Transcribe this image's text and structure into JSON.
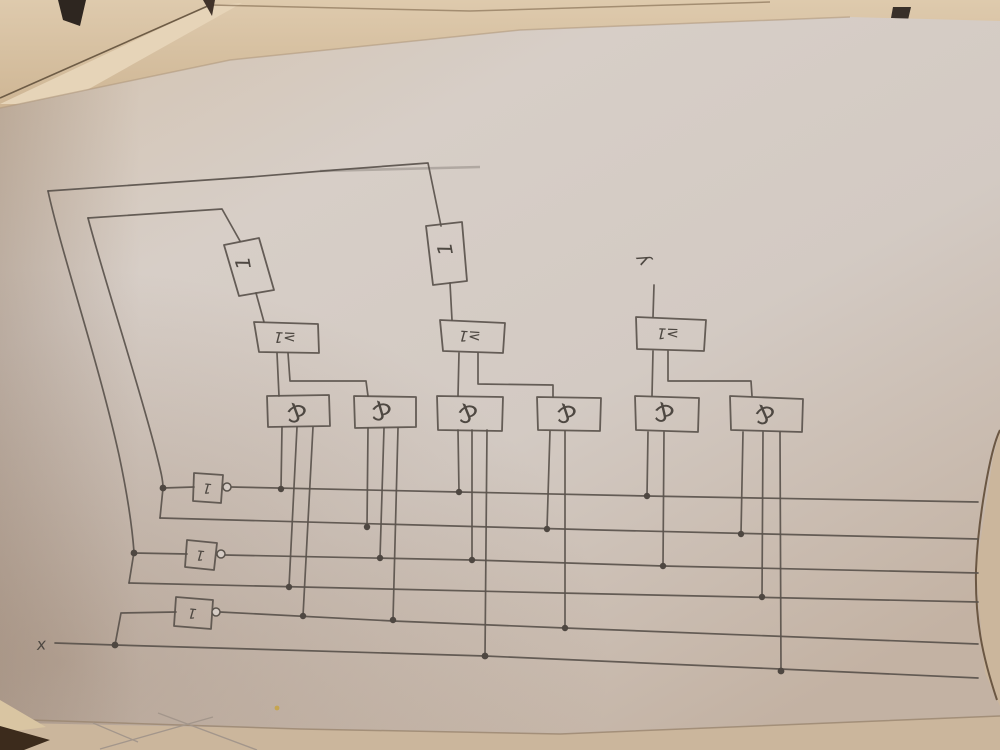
{
  "scene": {
    "description": "Photograph of a hand-drawn digital logic schematic (IEC rectangular symbols) in pencil on a sheet of paper lying on a brown surface with other papers",
    "paper_color": "#d6cdc6",
    "ink_color": "#5a534c",
    "surface_color": "#3c2b1c",
    "top_papers_color": "#e0cdb1"
  },
  "ports": {
    "input": "x",
    "output": "y"
  },
  "gates": {
    "buffers": [
      {
        "label": "1"
      },
      {
        "label": "1"
      }
    ],
    "or_gates": [
      {
        "label": "≥1"
      },
      {
        "label": "≥1"
      },
      {
        "label": "≥1"
      }
    ],
    "and_gates": [
      {
        "label": "&"
      },
      {
        "label": "&"
      },
      {
        "label": "&"
      },
      {
        "label": "&"
      },
      {
        "label": "&"
      },
      {
        "label": "&"
      }
    ],
    "inverters": [
      {
        "label": "1"
      },
      {
        "label": "1"
      },
      {
        "label": "1"
      }
    ]
  },
  "counts": {
    "or_gates": 3,
    "and_gates": 6,
    "inverters": 3,
    "buffers": 2,
    "horizontal_bus_lines": 6
  }
}
